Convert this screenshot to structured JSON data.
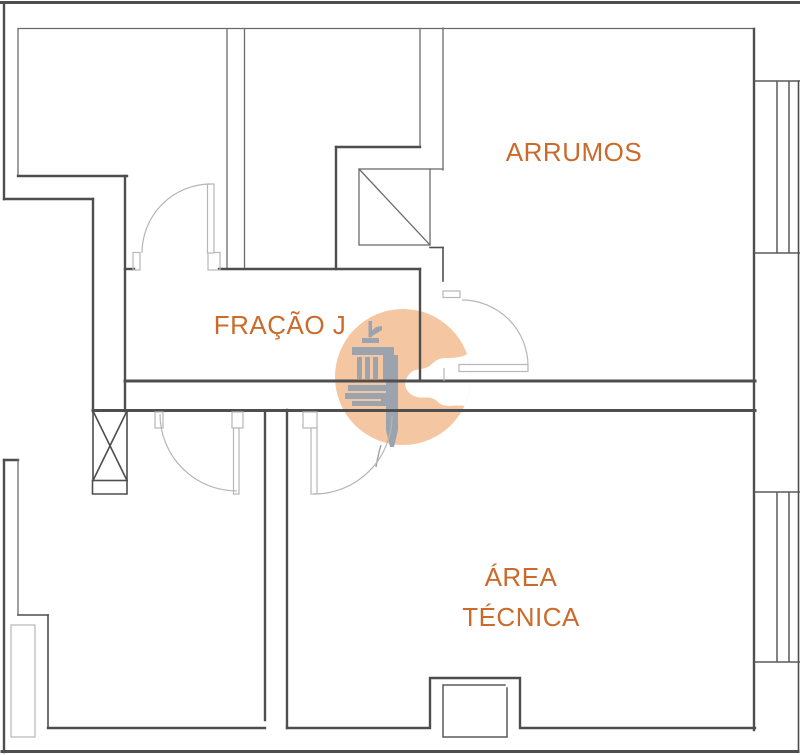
{
  "document": {
    "kind": "architectural floor plan"
  },
  "rooms": {
    "arrumos_label": "ARRUMOS",
    "fracao_label": "FRAÇÃO J",
    "area_tecnica_line1": "ÁREA",
    "area_tecnica_line2": "TÉCNICA"
  },
  "watermark": {
    "icon": "column-caliper-logo-icon",
    "shape": "circle"
  },
  "colors": {
    "room_label": "#ca6b2c",
    "walls": "#4e4e4e",
    "thin_lines": "#6b6b6b",
    "door_lines": "#b6b6b6",
    "watermark_circle": "#f4c7a2",
    "watermark_logo": "#9ba3af",
    "background": "#ffffff"
  }
}
